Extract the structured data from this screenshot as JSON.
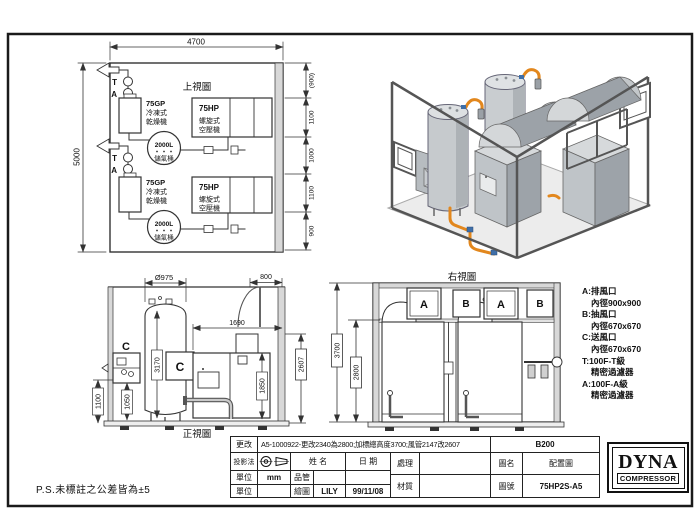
{
  "page": {
    "tolerance_note": "P.S.未標註之公差皆為±5"
  },
  "colors": {
    "pipe_orange": "#e2871d",
    "equipment_gray": "#c6cacd",
    "wall_gray": "#d8d8d8",
    "line_dark": "#333333"
  },
  "plan_view": {
    "title": "上視圖",
    "dim_width": "4700",
    "dim_height": "5000",
    "dim_chain": [
      "(900)",
      "1100",
      "1000",
      "1100",
      "900"
    ],
    "filter_t": "T",
    "filter_a": "A",
    "dryer": {
      "model": "75GP",
      "name_line1": "冷凍式",
      "name_line2": "乾燥機"
    },
    "tank": {
      "model": "2000L",
      "name": "儲氣桶"
    },
    "compressor": {
      "model": "75HP",
      "name_line1": "螺旋式",
      "name_line2": "空壓機"
    }
  },
  "front_view": {
    "title": "正視圖",
    "dim_tank_dia": "Ø975",
    "dim_door": "800",
    "dim_1690": "1690",
    "dim_3170": "3170",
    "dim_1100": "1100",
    "dim_1050": "1050",
    "dim_1850": "1850",
    "dim_2607": "2607",
    "vent_label": "C"
  },
  "right_view": {
    "title": "右視圖",
    "dim_3700": "3700",
    "dim_2800": "2800",
    "vent_a": "A",
    "vent_b": "B"
  },
  "legend": {
    "items": [
      {
        "line1": "A:排風口",
        "line2": "內徑900x900"
      },
      {
        "line1": "B:抽風口",
        "line2": "內徑670x670"
      },
      {
        "line1": "C:送風口",
        "line2": "內徑670x670"
      },
      {
        "line1": "T:100F-T級",
        "line2": "精密過濾器"
      },
      {
        "line1": "A:100F-A級",
        "line2": "精密過濾器"
      }
    ]
  },
  "title_block": {
    "revision_label": "更改",
    "revision_text": "A5-1000922-更改2340為2800;加標總高度3700;風管2147改2607",
    "sheet_code": "B200",
    "projection_label": "投影法",
    "name_header": "姓 名",
    "date_header": "日 期",
    "unit_label": "單位",
    "unit_value": "mm",
    "qc_label": "品管",
    "unit_label2": "單位",
    "draftsman_label": "繪圖",
    "draftsman_name": "LILY",
    "draft_date": "99/11/08",
    "process_label": "處理",
    "material_label": "材質",
    "drawing_name_label": "圖名",
    "drawing_name": "配置圖",
    "drawing_no_label": "圖號",
    "drawing_no": "75HP2S-A5"
  },
  "logo": {
    "brand": "DYNA",
    "sub_brand": "COMPRESSOR"
  }
}
